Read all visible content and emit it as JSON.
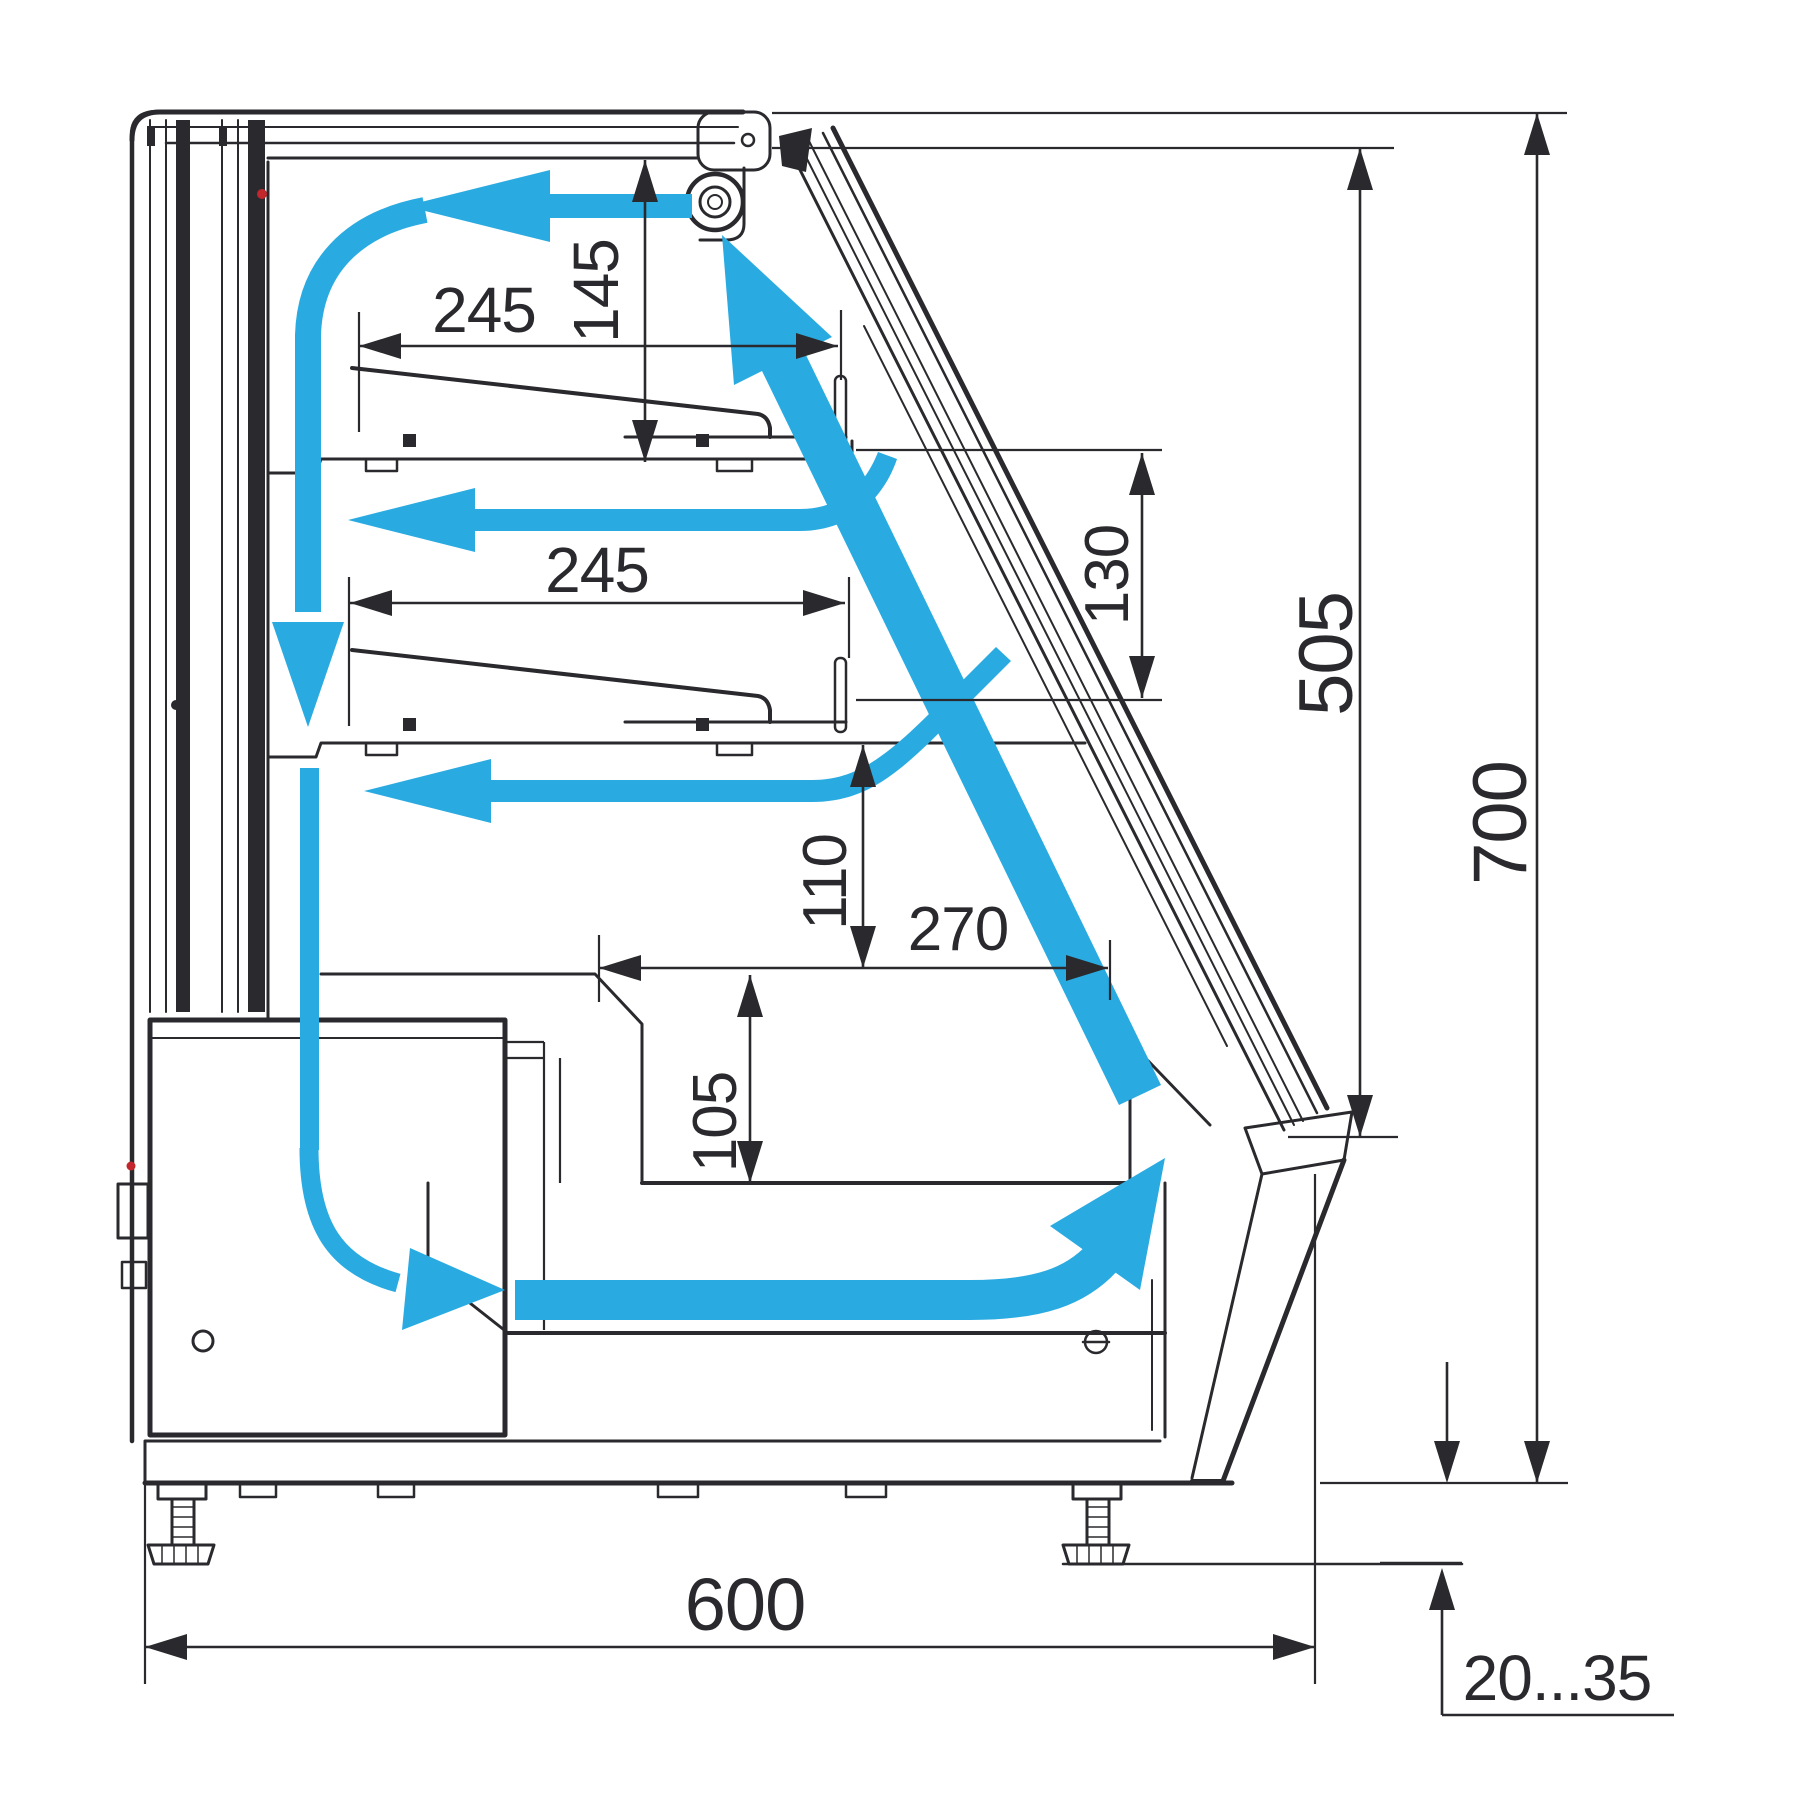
{
  "diagram": {
    "title": "Refrigerated display case cross-section with airflow",
    "unit": "mm",
    "colors": {
      "line": "#2a2a2e",
      "airflow": "#29abe2",
      "indicator_red": "#c1272d",
      "background": "#ffffff"
    }
  },
  "dims": {
    "shelf_top_depth": "245",
    "top_clearance": "145",
    "shelf_mid_depth": "245",
    "shelf_spacing": "130",
    "glass_height": "505",
    "overall_height": "700",
    "deck_clearance": "110",
    "well_width": "270",
    "well_depth": "105",
    "overall_depth": "600",
    "foot_adjust_range": "20...35"
  }
}
